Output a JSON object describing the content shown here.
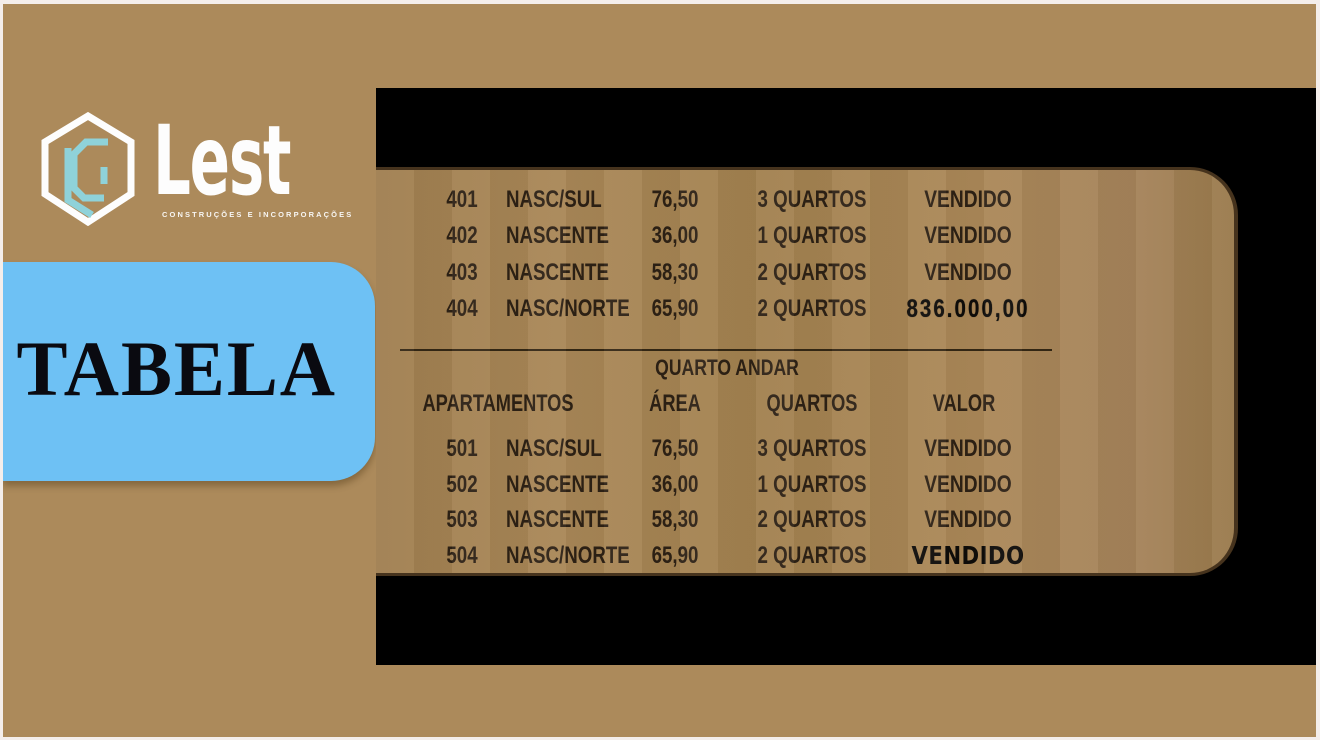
{
  "brand": {
    "name": "Lest",
    "tagline": "CONSTRUÇÕES E INCORPORAÇÕES",
    "logo_icon": "hexagon-lc-monogram"
  },
  "slide_title": "TABELA",
  "table": {
    "upper": {
      "rows": [
        {
          "apt": "401",
          "orientation": "NASC/SUL",
          "area": "76,50",
          "quartos": "3 QUARTOS",
          "valor": "VENDIDO",
          "valor_style": "normal"
        },
        {
          "apt": "402",
          "orientation": "NASCENTE",
          "area": "36,00",
          "quartos": "1 QUARTOS",
          "valor": "VENDIDO",
          "valor_style": "normal"
        },
        {
          "apt": "403",
          "orientation": "NASCENTE",
          "area": "58,30",
          "quartos": "2 QUARTOS",
          "valor": "VENDIDO",
          "valor_style": "normal"
        },
        {
          "apt": "404",
          "orientation": "NASC/NORTE",
          "area": "65,90",
          "quartos": "2 QUARTOS",
          "valor": "836.000,00",
          "valor_style": "price"
        }
      ]
    },
    "lower": {
      "floor_label": "QUARTO ANDAR",
      "headers": [
        "APARTAMENTOS",
        "ÁREA",
        "QUARTOS",
        "VALOR"
      ],
      "rows": [
        {
          "apt": "501",
          "orientation": "NASC/SUL",
          "area": "76,50",
          "quartos": "3 QUARTOS",
          "valor": "VENDIDO",
          "valor_style": "normal"
        },
        {
          "apt": "502",
          "orientation": "NASCENTE",
          "area": "36,00",
          "quartos": "1 QUARTOS",
          "valor": "VENDIDO",
          "valor_style": "normal"
        },
        {
          "apt": "503",
          "orientation": "NASCENTE",
          "area": "58,30",
          "quartos": "2 QUARTOS",
          "valor": "VENDIDO",
          "valor_style": "normal"
        },
        {
          "apt": "504",
          "orientation": "NASC/NORTE",
          "area": "65,90",
          "quartos": "2 QUARTOS",
          "valor": "VENDIDO",
          "valor_style": "bold"
        }
      ]
    }
  },
  "colors": {
    "frame_offwhite": "#f4eeeb",
    "slide_background": "#ac8a5b",
    "panel_black": "#000000",
    "card_tan": "#a5835a",
    "card_border": "#46331d",
    "title_box_blue": "#6ec1f4",
    "logo_teal": "#8fd2d9",
    "logo_white": "#fdfdfd",
    "text_dark": "#2d2115"
  }
}
